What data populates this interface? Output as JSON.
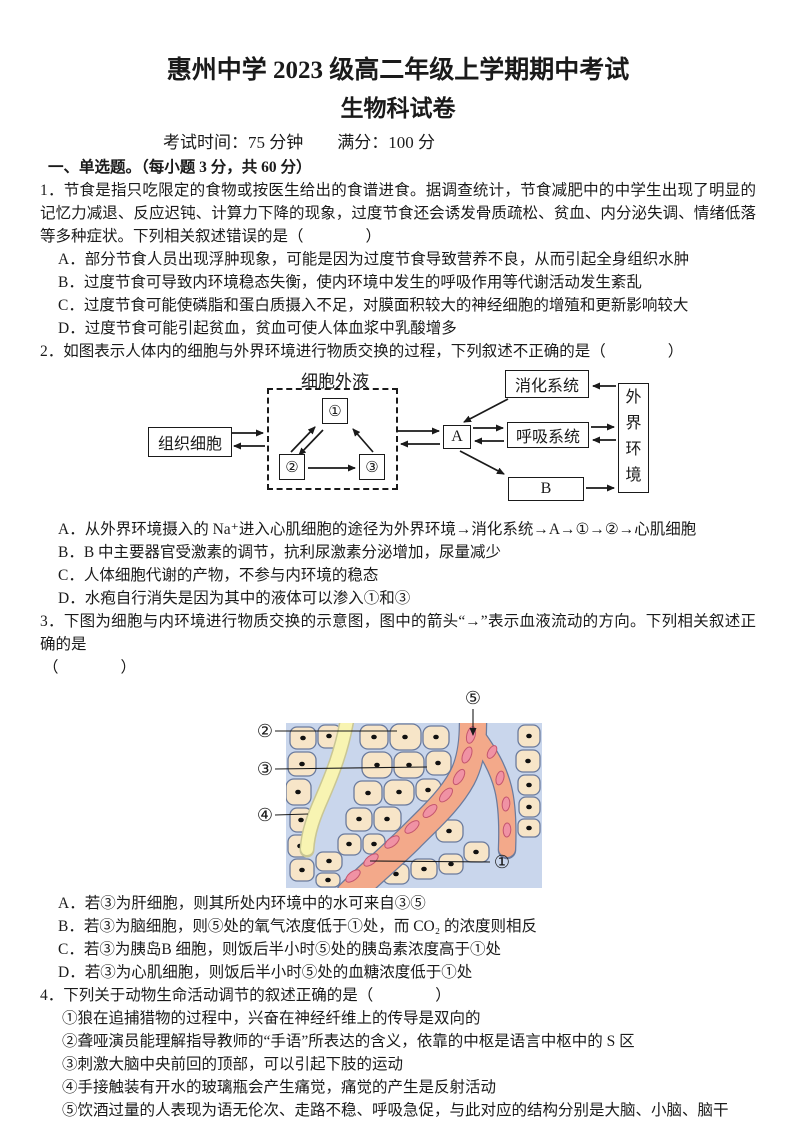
{
  "page": {
    "title_line1": "惠州中学 2023 级高二年级上学期期中考试",
    "title_line2": "生物科试卷",
    "exam_info": "考试时间：75 分钟　　满分：100 分",
    "section_heading": "一、单选题。（每小题 3 分，共 60 分）"
  },
  "q1": {
    "stem": "1．节食是指只吃限定的食物或按医生给出的食谱进食。据调查统计，节食减肥中的中学生出现了明显的记忆力减退、反应迟钝、计算力下降的现象，过度节食还会诱发骨质疏松、贫血、内分泌失调、情绪低落等多种症状。下列相关叙述错误的是（　　　　）",
    "options": [
      "A．部分节食人员出现浮肿现象，可能是因为过度节食导致营养不良，从而引起全身组织水肿",
      "B．过度节食可导致内环境稳态失衡，使内环境中发生的呼吸作用等代谢活动发生紊乱",
      "C．过度节食可能使磷脂和蛋白质摄入不足，对膜面积较大的神经细胞的增殖和更新影响较大",
      "D．过度节食可能引起贫血，贫血可使人体血浆中乳酸增多"
    ]
  },
  "q2": {
    "stem": "2．如图表示人体内的细胞与外界环境进行物质交换的过程，下列叙述不正确的是（　　　　）",
    "diagram": {
      "extracellular_fluid": "细胞外液",
      "tissue_cells": "组织细胞",
      "node1": "①",
      "node2": "②",
      "node3": "③",
      "node_a": "A",
      "node_b": "B",
      "digestive_system": "消化系统",
      "respiratory_system": "呼吸系统",
      "external_environment": "外界环境"
    },
    "options": [
      "A．从外界环境摄入的 Na⁺进入心肌细胞的途径为外界环境→消化系统→A→①→②→心肌细胞",
      "B．B 中主要器官受激素的调节，抗利尿激素分泌增加，尿量减少",
      "C．人体细胞代谢的产物，不参与内环境的稳态",
      "D．水疱自行消失是因为其中的液体可以渗入①和③"
    ]
  },
  "q3": {
    "stem": "3．下图为细胞与内环境进行物质交换的示意图，图中的箭头“→”表示血液流动的方向。下列相关叙述正确的是",
    "stem_cont": "（　　　　）",
    "diagram": {
      "label1": "①",
      "label2": "②",
      "label3": "③",
      "label4": "④",
      "label5": "⑤",
      "colors": {
        "background": "#c9d6ec",
        "cell_fill": "#f7e5c8",
        "vessel_fill": "#f3a98a",
        "vessel_edge": "#6b7b9d",
        "blood_cell_fill": "#f092a4",
        "lymph_fill": "#f8f4b2",
        "lymph_edge": "#c9c694"
      }
    },
    "options": [
      "A．若③为肝细胞，则其所处内环境中的水可来自③⑤",
      "B．若③为脑细胞，则⑤处的氧气浓度低于①处，而 CO₂ 的浓度则相反",
      "C．若③为胰岛B 细胞，则饭后半小时⑤处的胰岛素浓度高于①处",
      "D．若③为心肌细胞，则饭后半小时⑤处的血糖浓度低于①处"
    ]
  },
  "q4": {
    "stem": "4．下列关于动物生命活动调节的叙述正确的是（　　　　）",
    "statements": [
      "①狼在追捕猎物的过程中，兴奋在神经纤维上的传导是双向的",
      "②聋哑演员能理解指导教师的“手语”所表达的含义，依靠的中枢是语言中枢中的 S 区",
      "③刺激大脑中央前回的顶部，可以引起下肢的运动",
      "④手接触装有开水的玻璃瓶会产生痛觉，痛觉的产生是反射活动",
      "⑤饮酒过量的人表现为语无伦次、走路不稳、呼吸急促，与此对应的结构分别是大脑、小脑、脑干"
    ],
    "choices": [
      "A.　①③⑤",
      "B.　②③",
      "C.　②④⑤",
      "D.　③⑤"
    ]
  }
}
